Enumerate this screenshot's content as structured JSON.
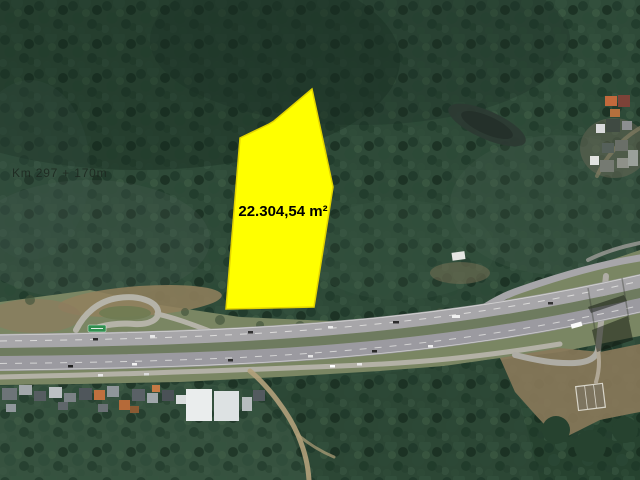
{
  "image": {
    "km_marker": {
      "text": "Km 297 + 170m"
    },
    "parcel": {
      "area_label": "22.304,54 m²",
      "points": "312,89 274,121 269,124 240,138 226,309 314,307 333,187"
    },
    "colors": {
      "parcel-fill": "#ffff00",
      "parcel-stroke": "#e3d400",
      "parcel-label": "#000000",
      "km-label": "#1b241d",
      "forest-base": "#2e4a38",
      "corridor-grass": "#7a8663",
      "asphalt-upper": "#a7a6a9",
      "asphalt-lower": "#9b9aa0",
      "median-grass": "#6e7b5f",
      "dirt-tan": "#92805d",
      "sign-green": "#2f8f4f"
    }
  }
}
